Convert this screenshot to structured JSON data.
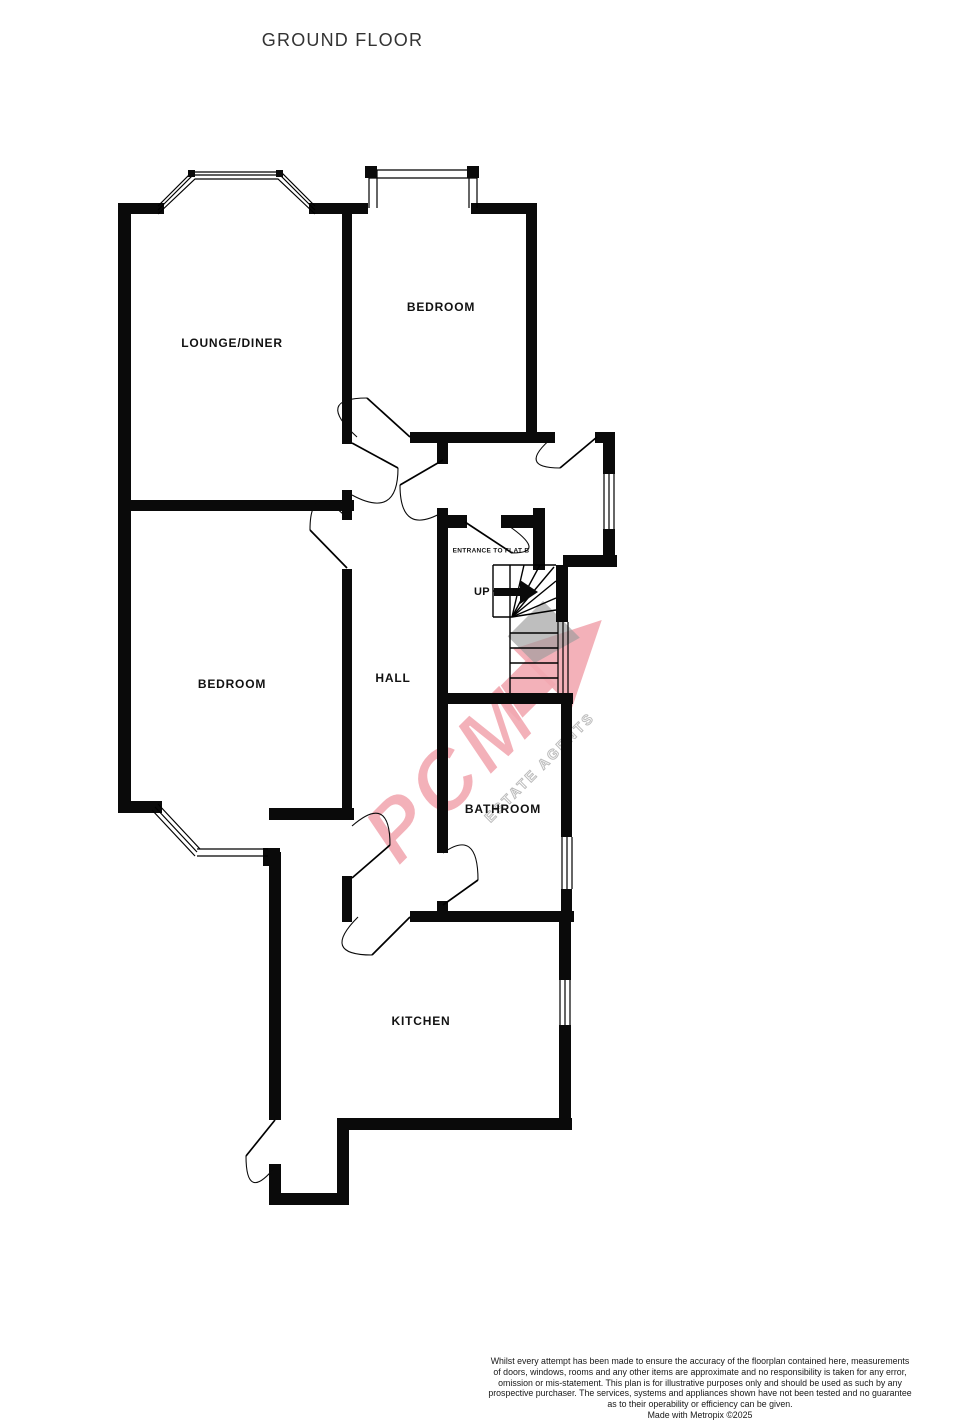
{
  "title": "GROUND FLOOR",
  "floorplan": {
    "rooms": [
      {
        "label": "LOUNGE/DINER"
      },
      {
        "label": "BEDROOM"
      },
      {
        "label": "BEDROOM"
      },
      {
        "label": "HALL"
      },
      {
        "label": "BATHROOM"
      },
      {
        "label": "KITCHEN"
      }
    ],
    "annotations": {
      "entrance_label": "ENTRANCE TO FLAT B",
      "stairs_direction": "UP"
    }
  },
  "watermark": {
    "brand": "PCM",
    "tagline": "ESTATE AGENTS",
    "accent_color": "#f2a8b1"
  },
  "footer": {
    "lines": [
      "Whilst every attempt has been made to ensure the accuracy of the floorplan contained here, measurements",
      "of doors, windows, rooms and any other items are approximate and no responsibility is taken for any error,",
      "omission or mis-statement. This plan is for illustrative purposes only and should be used as such by any",
      "prospective purchaser. The services, systems and appliances shown have not been tested and no guarantee",
      "as to their operability or efficiency can be given.",
      "Made with Metropix ©2025"
    ]
  }
}
